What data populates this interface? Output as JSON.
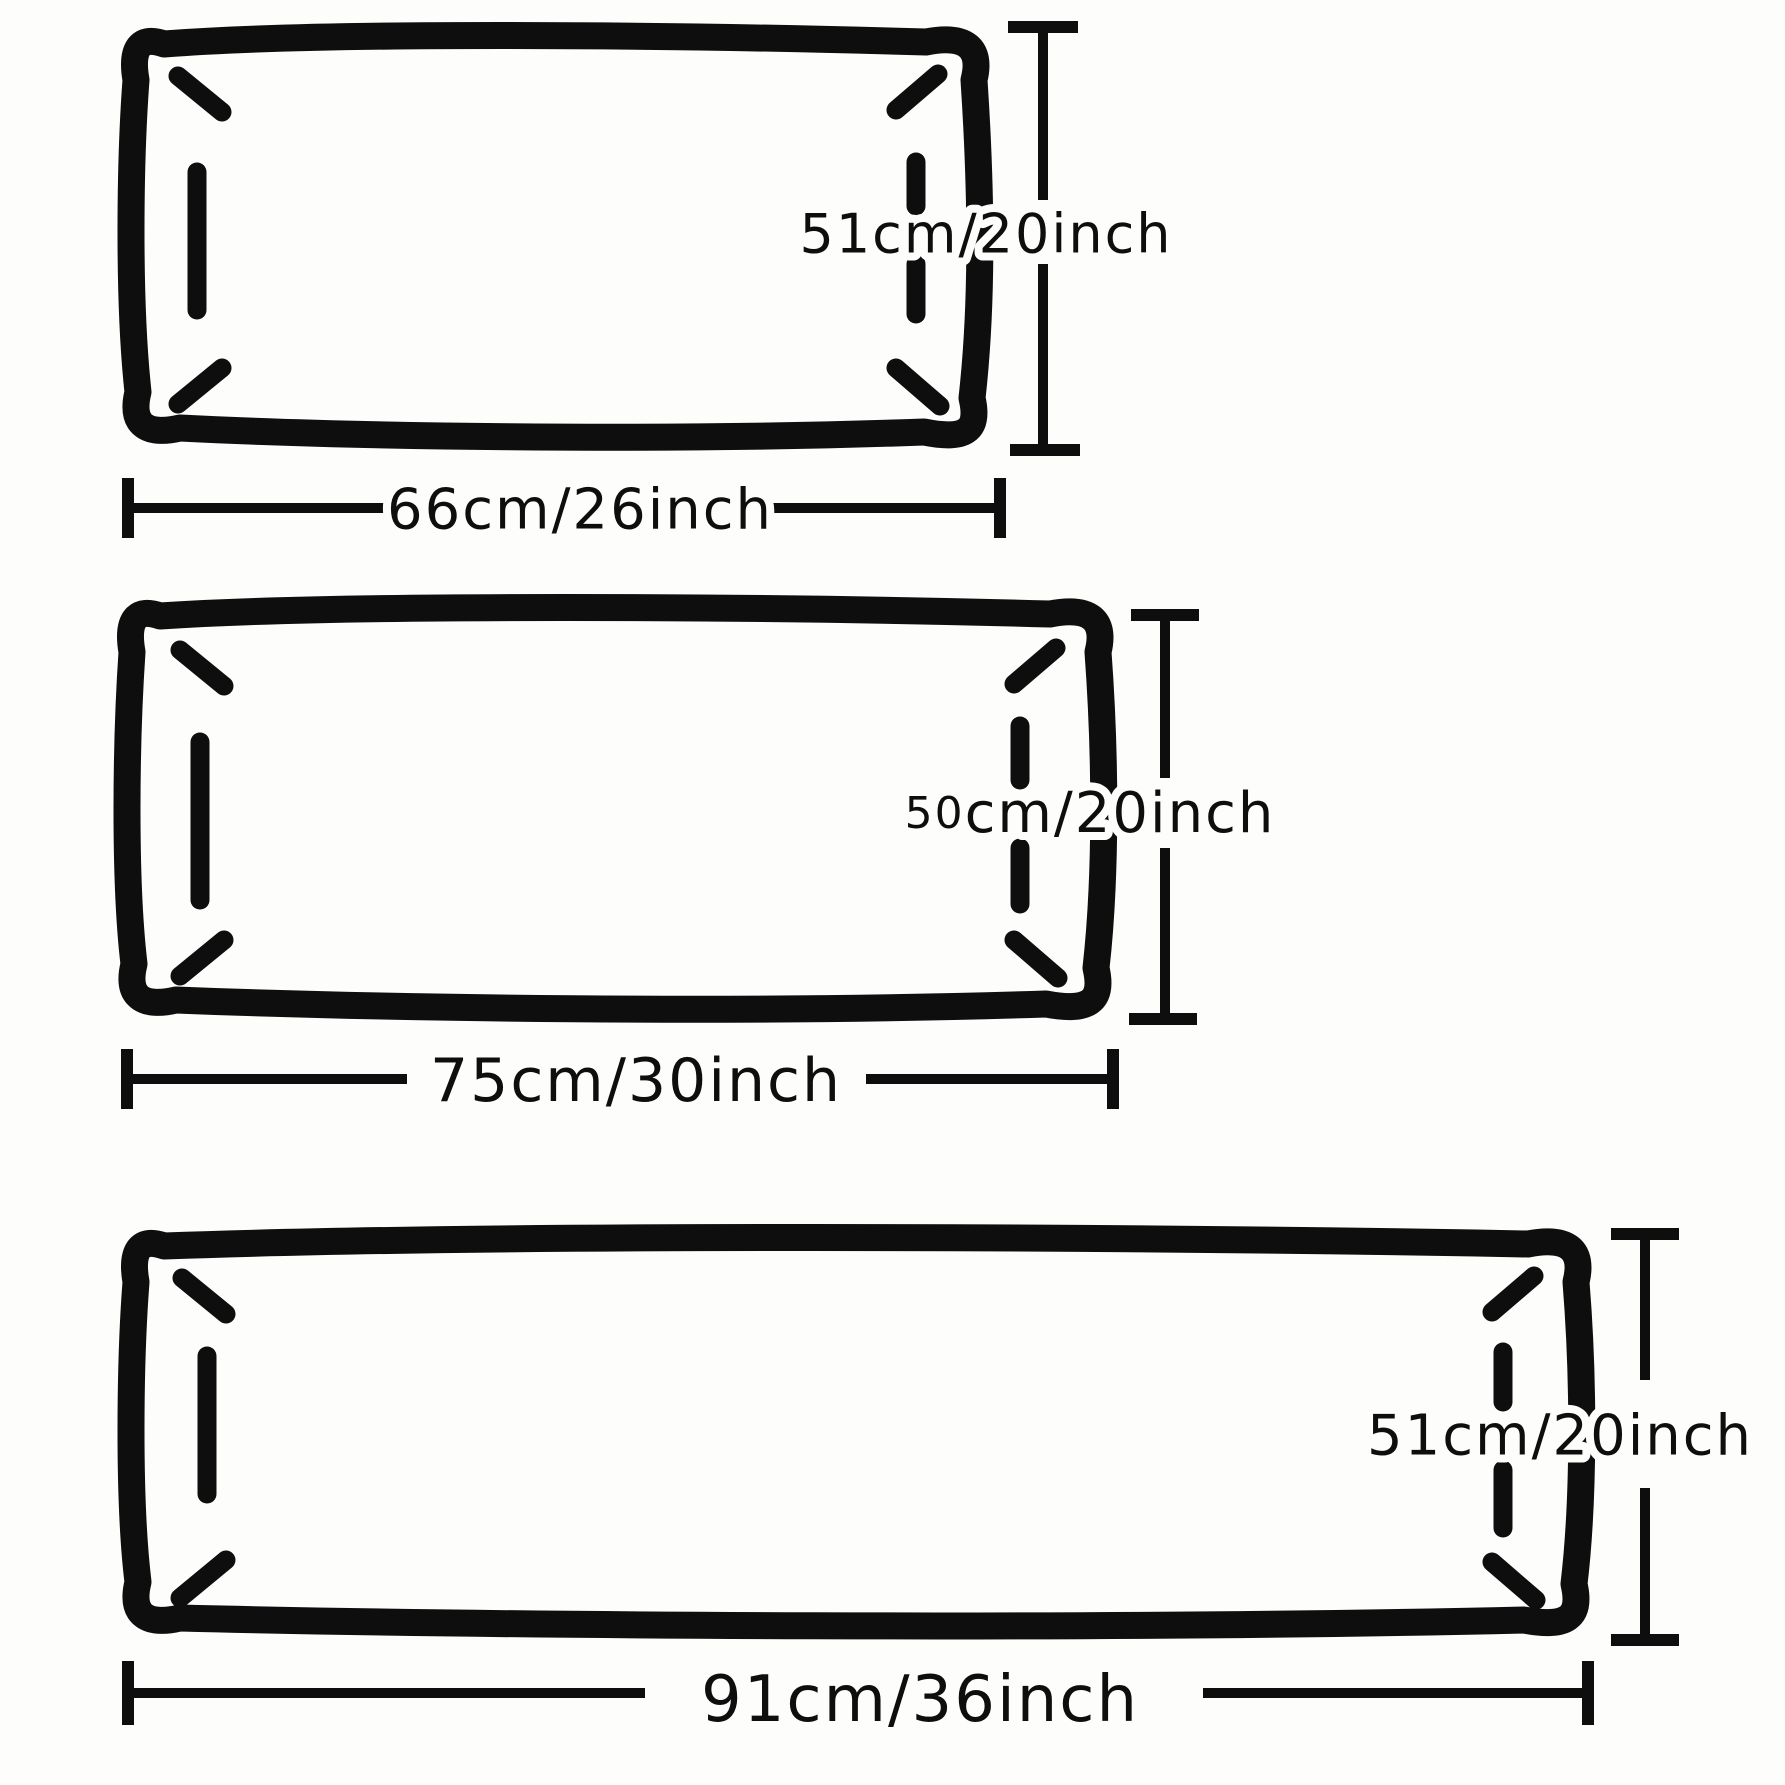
{
  "diagram": {
    "kind": "pillowcase-size-diagram",
    "colors": {
      "ink": "#0e0e0e",
      "background": "#fdfdfb"
    },
    "pillows": [
      {
        "height_label": "51cm/20inch",
        "width_label": "66cm/26inch"
      },
      {
        "height_label_prefix": "50",
        "height_label_rest": "cm/20inch",
        "width_label": "75cm/30inch"
      },
      {
        "height_label": "51cm/20inch",
        "width_label": "91cm/36inch"
      }
    ]
  }
}
